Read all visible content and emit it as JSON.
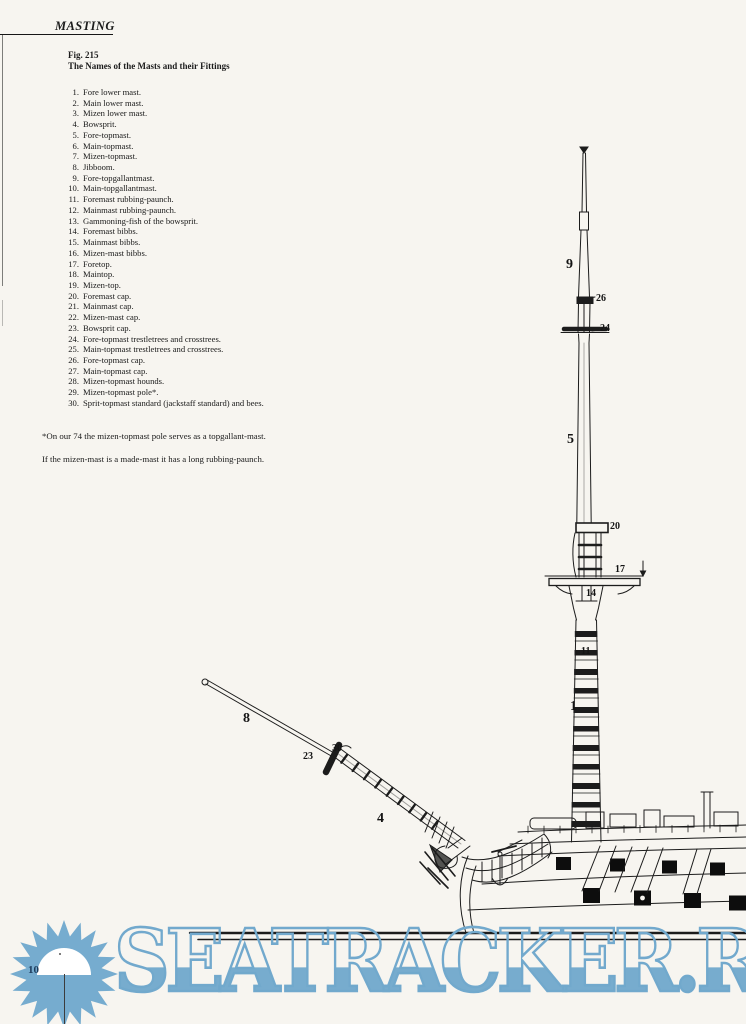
{
  "page": {
    "header": "MASTING",
    "page_number": "10"
  },
  "figure": {
    "label": "Fig. 215",
    "title": "The Names of the Masts and their Fittings",
    "items": [
      {
        "num": "1.",
        "text": "Fore lower mast."
      },
      {
        "num": "2.",
        "text": "Main lower mast."
      },
      {
        "num": "3.",
        "text": "Mizen lower mast."
      },
      {
        "num": "4.",
        "text": "Bowsprit."
      },
      {
        "num": "5.",
        "text": "Fore-topmast."
      },
      {
        "num": "6.",
        "text": "Main-topmast."
      },
      {
        "num": "7.",
        "text": "Mizen-topmast."
      },
      {
        "num": "8.",
        "text": "Jibboom."
      },
      {
        "num": "9.",
        "text": "Fore-topgallantmast."
      },
      {
        "num": "10.",
        "text": "Main-topgallantmast."
      },
      {
        "num": "11.",
        "text": "Foremast rubbing-paunch."
      },
      {
        "num": "12.",
        "text": "Mainmast rubbing-paunch."
      },
      {
        "num": "13.",
        "text": "Gammoning-fish of the bowsprit."
      },
      {
        "num": "14.",
        "text": "Foremast bibbs."
      },
      {
        "num": "15.",
        "text": "Mainmast bibbs."
      },
      {
        "num": "16.",
        "text": "Mizen-mast bibbs."
      },
      {
        "num": "17.",
        "text": "Foretop."
      },
      {
        "num": "18.",
        "text": "Maintop."
      },
      {
        "num": "19.",
        "text": "Mizen-top."
      },
      {
        "num": "20.",
        "text": "Foremast cap."
      },
      {
        "num": "21.",
        "text": "Mainmast cap."
      },
      {
        "num": "22.",
        "text": "Mizen-mast cap."
      },
      {
        "num": "23.",
        "text": "Bowsprit cap."
      },
      {
        "num": "24.",
        "text": "Fore-topmast trestletrees and crosstrees."
      },
      {
        "num": "25.",
        "text": "Main-topmast trestletrees and crosstrees."
      },
      {
        "num": "26.",
        "text": "Fore-topmast cap."
      },
      {
        "num": "27.",
        "text": "Main-topmast cap."
      },
      {
        "num": "28.",
        "text": "Mizen-topmast hounds."
      },
      {
        "num": "29.",
        "text": "Mizen-topmast pole*."
      },
      {
        "num": "30.",
        "text": "Sprit-topmast standard (jackstaff standard) and bees."
      }
    ],
    "footnote1": "*On our 74 the mizen-topmast pole serves as a topgallant-mast.",
    "footnote2": "If the mizen-mast is a made-mast it has a long rubbing-paunch.",
    "callouts": [
      {
        "n": "9",
        "x": 566,
        "y": 257,
        "size": "lg"
      },
      {
        "n": "26",
        "x": 596,
        "y": 293,
        "size": "sm"
      },
      {
        "n": "24",
        "x": 600,
        "y": 323,
        "size": "sm"
      },
      {
        "n": "5",
        "x": 567,
        "y": 432,
        "size": "lg"
      },
      {
        "n": "20",
        "x": 610,
        "y": 521,
        "size": "sm"
      },
      {
        "n": "17",
        "x": 615,
        "y": 564,
        "size": "sm"
      },
      {
        "n": "14",
        "x": 586,
        "y": 588,
        "size": "sm"
      },
      {
        "n": "11",
        "x": 581,
        "y": 646,
        "size": "sm"
      },
      {
        "n": "1",
        "x": 570,
        "y": 699,
        "size": "lg"
      },
      {
        "n": "8",
        "x": 243,
        "y": 711,
        "size": "lg"
      },
      {
        "n": "23",
        "x": 303,
        "y": 751,
        "size": "sm"
      },
      {
        "n": "30",
        "x": 332,
        "y": 743,
        "size": "sm"
      },
      {
        "n": "4",
        "x": 377,
        "y": 811,
        "size": "lg"
      }
    ]
  },
  "watermark": {
    "text": "SEATRACKER.RU",
    "color": "#72a9cd"
  }
}
